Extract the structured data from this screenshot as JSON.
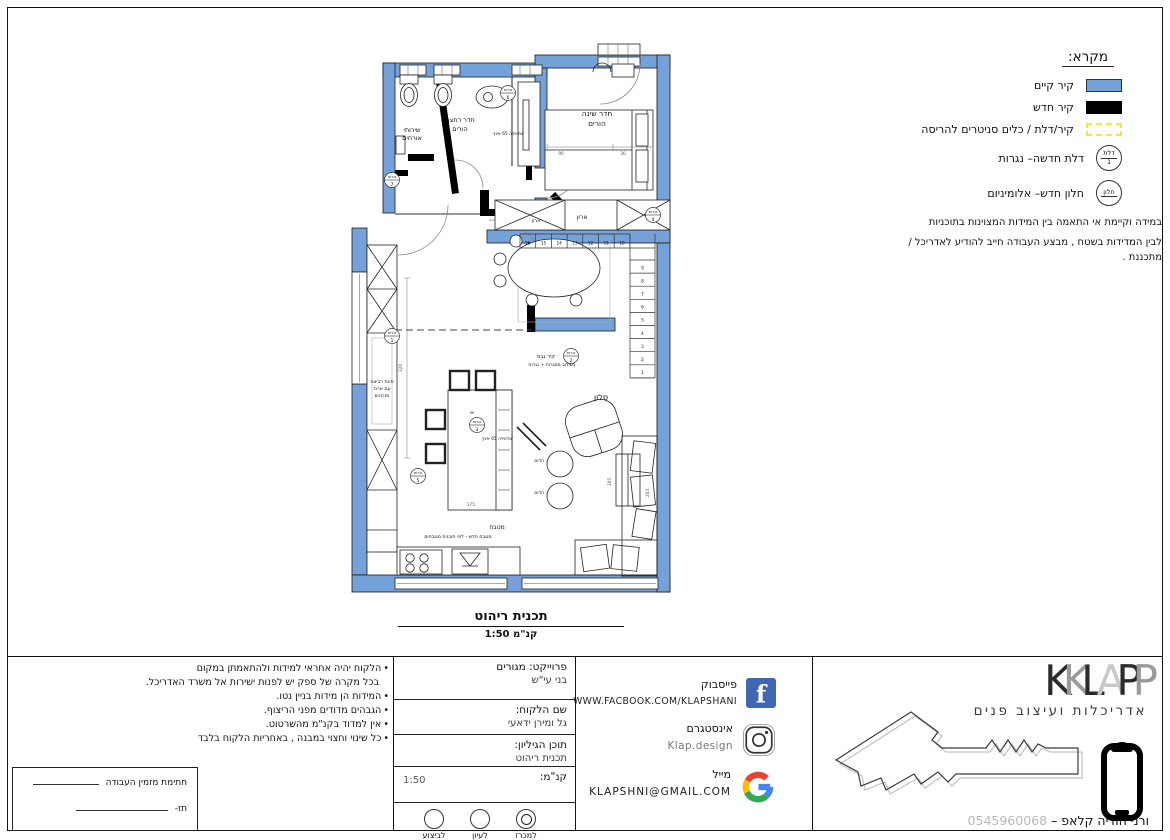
{
  "legend": {
    "title": "מקרא:",
    "rows": [
      {
        "label": "קיר קיים"
      },
      {
        "label": "קיר חדש"
      },
      {
        "label": "קיר/דלת / כלים סניטרים להריסה"
      },
      {
        "label": "דלת חדשה– נגרות",
        "symbol_top": "דלת",
        "symbol_bottom": "1"
      },
      {
        "label": "חלון חדש– אלומיניום",
        "symbol_top": "חלון",
        "symbol_bottom": ""
      }
    ],
    "note_line1": "במידה וקיימת אי התאמה בין המידות המצוינות בתוכניות",
    "note_line2": "לבין המדידות בשטח , מבצע העבודה חייב להודיע לאדריכל / מתכננת ."
  },
  "plan": {
    "title": "תכנית  ריהוט",
    "scale": "קנ\"מ  1:50",
    "carpentry_word": "נגרות",
    "carpentry_refs": [
      {
        "n": "1",
        "x": 42,
        "y": 298
      },
      {
        "n": "2",
        "x": 221,
        "y": 318
      },
      {
        "n": "3",
        "x": 127,
        "y": 387
      },
      {
        "n": "4",
        "x": 303,
        "y": 177
      },
      {
        "n": "5",
        "x": 68,
        "y": 438
      },
      {
        "n": "6",
        "x": 158,
        "y": 55
      },
      {
        "n": "7",
        "x": 42,
        "y": 142
      }
    ],
    "labels": [
      {
        "t": "שירותי",
        "x": 62,
        "y": 94,
        "s": 6.5
      },
      {
        "t": "אורחים",
        "x": 62,
        "y": 102,
        "s": 6.5
      },
      {
        "t": "חדר רחצה",
        "x": 110,
        "y": 84,
        "s": 6.5
      },
      {
        "t": "הורים",
        "x": 110,
        "y": 93,
        "s": 6.5
      },
      {
        "t": "חדר שינה",
        "x": 247,
        "y": 78,
        "s": 7.5
      },
      {
        "t": "הורים",
        "x": 247,
        "y": 88,
        "s": 7.5
      },
      {
        "t": "טלוויזיה 65 אינץ'",
        "x": 174,
        "y": 97,
        "s": 4.3,
        "a": "end"
      },
      {
        "t": "ארון",
        "x": 232,
        "y": 181,
        "s": 6
      },
      {
        "t": "ארון",
        "x": 186,
        "y": 184,
        "s": 4.8
      },
      {
        "t": "סלון",
        "x": 251,
        "y": 362,
        "s": 8
      },
      {
        "t": "הדום",
        "x": 194,
        "y": 424,
        "s": 4.5,
        "a": "end"
      },
      {
        "t": "הדום",
        "x": 194,
        "y": 456,
        "s": 4.5,
        "a": "end"
      },
      {
        "t": "טלוויזיה 65 אינץ'",
        "x": 163,
        "y": 402,
        "s": 4.3,
        "a": "end"
      },
      {
        "t": "מטבח",
        "x": 147,
        "y": 491,
        "s": 6
      },
      {
        "t": "מטבח חדש - לפי תוכנית מטבחים",
        "x": 108,
        "y": 500,
        "s": 4.8
      },
      {
        "t": "אי",
        "x": 122,
        "y": 376,
        "s": 5
      },
      {
        "t": "פינת רביצה",
        "x": 32,
        "y": 345,
        "s": 4.8
      },
      {
        "t": "עם ארגז",
        "x": 32,
        "y": 352,
        "s": 4.8
      },
      {
        "t": "מזרונים",
        "x": 32,
        "y": 359,
        "s": 4.8
      },
      {
        "t": "קיר גבס",
        "x": 196,
        "y": 320,
        "s": 5.2
      },
      {
        "t": "בשילוב מסגרות + נגרות",
        "x": 202,
        "y": 328,
        "s": 4.6
      }
    ],
    "stairs_h": [
      "16",
      "15",
      "14",
      "13",
      "12",
      "11",
      "10"
    ],
    "stairs_v": [
      "9",
      "8",
      "7",
      "6",
      "5",
      "4",
      "3",
      "2",
      "1"
    ],
    "dims": [
      {
        "t": "320",
        "x": 52,
        "y": 330,
        "r": -90
      },
      {
        "t": "90",
        "x": 211,
        "y": 117
      },
      {
        "t": "30",
        "x": 273,
        "y": 117
      },
      {
        "t": "175",
        "x": 121,
        "y": 468
      },
      {
        "t": "203",
        "x": 299,
        "y": 455,
        "r": -90
      },
      {
        "t": "105",
        "x": 261,
        "y": 444,
        "r": -90
      }
    ]
  },
  "titleblock": {
    "notes": [
      "הלקוח יהיה אחראי למידות ולהתאמתן במקום",
      "בכל מקרה של ספק יש לפנות ישירות אל משרד האדריכל.",
      "המידות הן מידות בניין נטו.",
      "הגבהים מדודים מפני הריצוף.",
      "אין למדוד בקנ\"מ מהשרטוט.",
      "כל שינוי וחצוי במבנה , באחריות הלקוח בלבד"
    ],
    "signature": {
      "line1": "חתימת מזמין העבודה",
      "line2": "תז-"
    },
    "info": {
      "project_label": "פרוייקט: מגורים",
      "project_value": "בני עי\"ש",
      "client_label": "שם הלקוח:",
      "client_value": "גל ומירן ידאעי",
      "sheet_label": "תוכן הגיליון:",
      "sheet_value": "תכנית ריהוט",
      "scale_label": "קנ\"מ:",
      "scale_value": "1:50",
      "status_options": [
        {
          "label": "לביצוע",
          "selected": false
        },
        {
          "label": "לעיון",
          "selected": false
        },
        {
          "label": "למכרז",
          "selected": true
        }
      ]
    },
    "social": {
      "facebook_label": "פייסבוק",
      "facebook_value": "WWW.FACBOOK.COM/KLAPSHANI",
      "instagram_label": "אינסטגרם",
      "instagram_value": "Klap.design",
      "mail_label": "מייל",
      "mail_value": "KLAPSHNI@GMAIL.COM"
    },
    "brand": {
      "logo_letters": [
        "K",
        "K",
        "L",
        "A",
        "P",
        "P"
      ],
      "tagline": "אדריכלות ועיצוב פנים",
      "name": "ורני הודיה קלאפ",
      "dash": "–",
      "phone": "0545960068"
    },
    "colors": {
      "wall_existing": "#74a2d8",
      "demolition": "#efe93c",
      "facebook": "#4267B2"
    }
  }
}
